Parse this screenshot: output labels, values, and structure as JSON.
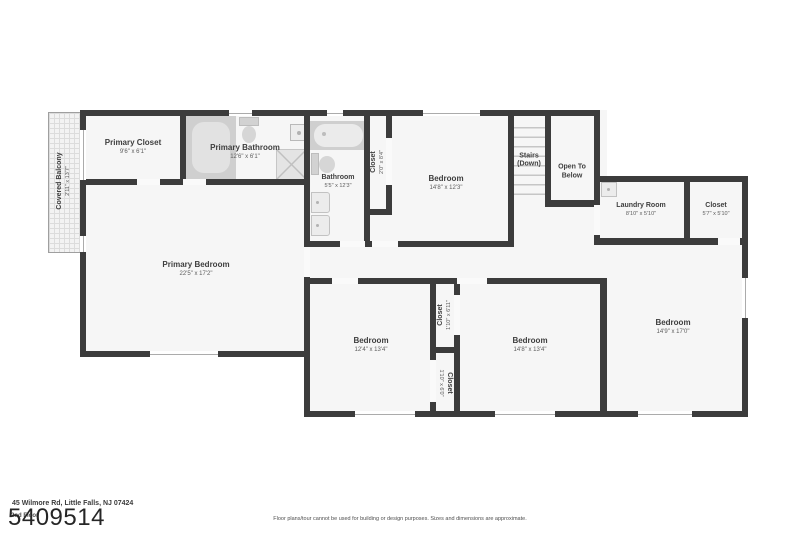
{
  "colors": {
    "wall": "#3c3c3c",
    "floor": "#f6f6f6",
    "fixture_dark": "#cfcfcf",
    "fixture_light": "#e7e7e7",
    "background": "#ffffff"
  },
  "rooms": {
    "covered_balcony": {
      "name": "Covered Balcony",
      "dims": "2'11\" x 13'7\""
    },
    "primary_closet": {
      "name": "Primary Closet",
      "dims": "9'6\" x 6'1\""
    },
    "primary_bathroom": {
      "name": "Primary Bathroom",
      "dims": "12'6\" x 6'1\""
    },
    "bathroom": {
      "name": "Bathroom",
      "dims": "5'5\" x 12'3\""
    },
    "hall_closet": {
      "name": "Closet",
      "dims": "2'0\" x 8'4\""
    },
    "bedroom_top": {
      "name": "Bedroom",
      "dims": "14'8\" x 12'3\""
    },
    "stairs": {
      "name": "Stairs",
      "sub": "(Down)"
    },
    "open_to_below": {
      "name": "Open To Below"
    },
    "laundry_room": {
      "name": "Laundry Room",
      "dims": "8'10\" x 5'10\""
    },
    "closet_ne": {
      "name": "Closet",
      "dims": "5'7\" x 5'10\""
    },
    "primary_bedroom": {
      "name": "Primary Bedroom",
      "dims": "22'5\" x 17'2\""
    },
    "bedroom_sw": {
      "name": "Bedroom",
      "dims": "12'4\" x 13'4\""
    },
    "closet_mid_upper": {
      "name": "Closet",
      "dims": "1'10\" x 6'11\""
    },
    "closet_mid_lower": {
      "name": "Closet",
      "dims": "1'10\" x 6'0\""
    },
    "bedroom_s": {
      "name": "Bedroom",
      "dims": "14'8\" x 13'4\""
    },
    "bedroom_e": {
      "name": "Bedroom",
      "dims": "14'9\" x 17'0\""
    }
  },
  "footer": {
    "address": "45 Wilmore Rd, Little Falls, NJ 07424",
    "floor_label": "2nd Floor",
    "listing_id": "5409514",
    "disclaimer": "Floor plans/tour cannot be used for building or design purposes. Sizes and dimensions are approximate."
  }
}
